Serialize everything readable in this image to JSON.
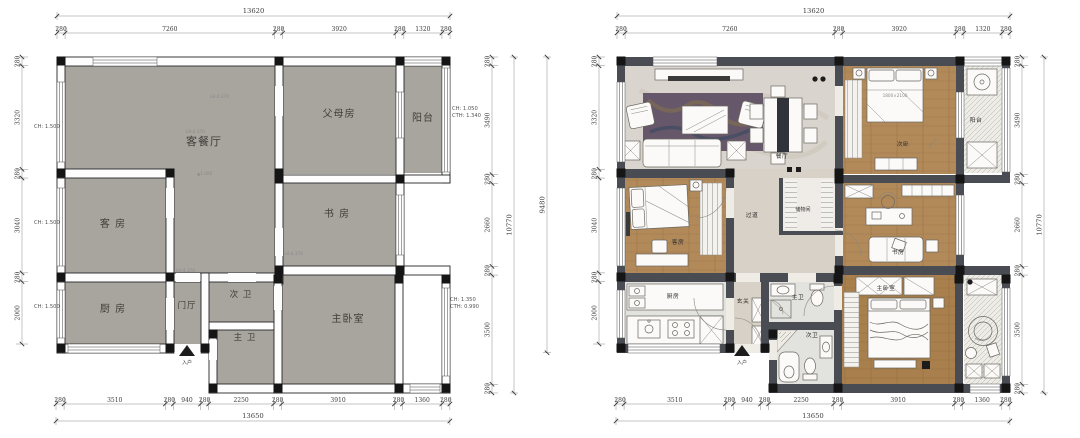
{
  "meta": {
    "type": "floor-plan-pair",
    "units": "mm"
  },
  "palette": {
    "left_room_fill": "#a8a49e",
    "right_wall": "#494d53",
    "wood": "#b28a5a",
    "wood_dark": "#a97f4e",
    "marble": "#d9d5ce",
    "corridor": "#d8d1c7",
    "tile": "#e2e2de",
    "balcony": "#edece7",
    "rug": "#66586a",
    "accent_dark": "#1c1c1c"
  },
  "plans": {
    "left": {
      "dims": {
        "top_total": "13620",
        "top": [
          "280",
          "7260",
          "280",
          "3920",
          "280",
          "1320",
          "280"
        ],
        "bottom": [
          "280",
          "3510",
          "280",
          "940",
          "280",
          "2250",
          "280",
          "3910",
          "280",
          "1360",
          "280"
        ],
        "bottom_total": "13650",
        "left": [
          "280",
          "3320",
          "280",
          "3040",
          "280",
          "2000"
        ],
        "right": [
          "280",
          "3490",
          "280",
          "2660",
          "280",
          "3500",
          "280"
        ],
        "right_total": "10770"
      },
      "rooms": [
        {
          "id": "living-dining",
          "label": "客餐厅"
        },
        {
          "id": "parents",
          "label": "父母房"
        },
        {
          "id": "balcony",
          "label": "阳台"
        },
        {
          "id": "guest",
          "label": "客 房"
        },
        {
          "id": "study",
          "label": "书 房"
        },
        {
          "id": "kitchen",
          "label": "厨 房"
        },
        {
          "id": "foyer",
          "label": "门厅"
        },
        {
          "id": "bath2",
          "label": "次 卫"
        },
        {
          "id": "bath1",
          "label": "主 卫"
        },
        {
          "id": "master",
          "label": "主卧室"
        },
        {
          "id": "entrance",
          "label": "入户"
        }
      ],
      "window_annotations": {
        "left": [
          "CH: 1.500",
          "CH: 1.500",
          "CH: 1.500"
        ],
        "right_top": [
          "CH: 1.050",
          "CTH: 1.340"
        ],
        "right_bottom": [
          "CH: 1.350",
          "CTH: 0.990"
        ]
      },
      "interior_annotations": [
        "LH:4.370",
        "LH:4.370",
        "LH:4.370",
        "LH:4.370",
        "▲1.000"
      ]
    },
    "right": {
      "dims": {
        "top_total": "13620",
        "top": [
          "280",
          "7260",
          "280",
          "3920",
          "280",
          "1320",
          "280"
        ],
        "bottom": [
          "280",
          "3510",
          "280",
          "940",
          "280",
          "2250",
          "280",
          "3910",
          "280",
          "1360",
          "280"
        ],
        "bottom_total": "13650",
        "left": [
          "280",
          "3320",
          "280",
          "3040",
          "280",
          "2000"
        ],
        "left_total": "9480",
        "right": [
          "280",
          "3490",
          "280",
          "2660",
          "280",
          "3500",
          "280"
        ],
        "right_total": "10770"
      },
      "rooms": [
        {
          "id": "dining",
          "label": "餐厅"
        },
        {
          "id": "bedroom2",
          "label": "次卧"
        },
        {
          "id": "balcony-top",
          "label": "阳台"
        },
        {
          "id": "guest",
          "label": "客房"
        },
        {
          "id": "hallway",
          "label": "过道"
        },
        {
          "id": "storage",
          "label": "储物间"
        },
        {
          "id": "study",
          "label": "书房"
        },
        {
          "id": "kitchen",
          "label": "厨房"
        },
        {
          "id": "entry",
          "label": "玄关"
        },
        {
          "id": "master-bath",
          "label": "主卫"
        },
        {
          "id": "bath2",
          "label": "次卫"
        },
        {
          "id": "master",
          "label": "主卧室"
        },
        {
          "id": "entrance",
          "label": "入户"
        }
      ],
      "bed_size_label": "1800×2100"
    }
  }
}
